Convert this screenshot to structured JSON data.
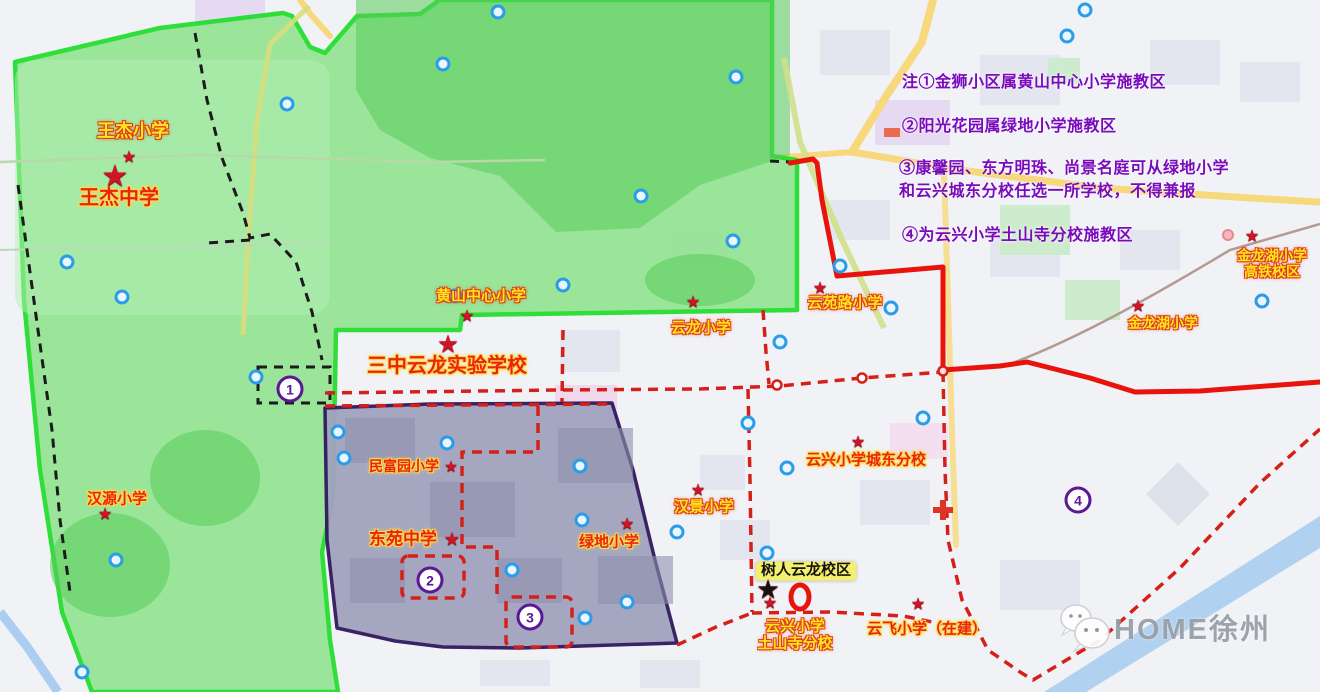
{
  "page": {
    "kind": "school-district-map"
  },
  "watermark": {
    "brand": "HOME徐州"
  },
  "colors": {
    "green_zone_border": "#1fdd2a",
    "green_zone_fill": "#93e493",
    "purple_zone_border": "#31175e",
    "purple_zone_fill": "#a2a3bf",
    "red_boundary": "#e8140c",
    "red_dashed": "#d5201a",
    "black_dashed": "#1b1b1b",
    "note_text": "#7a0bbd",
    "yellow_label": "#ffe520",
    "red_label": "#e8250f",
    "star_red": "#d31326",
    "zone_number": "#5a1796",
    "watermark_gray": "#979da6"
  },
  "notes": [
    {
      "text": "注①金狮小区属黄山中心小学施教区",
      "x": 902,
      "y": 68
    },
    {
      "text": "②阳光花园属绿地小学施教区",
      "x": 902,
      "y": 112
    },
    {
      "text": "③康馨园、东方明珠、尚景名庭可从绿地小学",
      "x": 899,
      "y": 154
    },
    {
      "text": "和云兴城东分校任选一所学校，不得兼报",
      "x": 899,
      "y": 177
    },
    {
      "text": "④为云兴小学土山寺分校施教区",
      "x": 902,
      "y": 221
    }
  ],
  "zone_markers": [
    {
      "n": "1",
      "x": 290,
      "y": 389
    },
    {
      "n": "2",
      "x": 430,
      "y": 580
    },
    {
      "n": "3",
      "x": 530,
      "y": 617
    },
    {
      "n": "4",
      "x": 1078,
      "y": 500
    }
  ],
  "schools": [
    {
      "id": "wangjie-primary",
      "lines": [
        "王杰小学"
      ],
      "style": "y",
      "x": 133,
      "y": 131,
      "fs": 18,
      "star": {
        "x": 129,
        "y": 158,
        "fs": 16
      }
    },
    {
      "id": "wangjie-middle",
      "lines": [
        "王杰中学"
      ],
      "style": "r",
      "x": 119,
      "y": 198,
      "fs": 20,
      "star": {
        "x": 115,
        "y": 177,
        "fs": 30
      }
    },
    {
      "id": "huangshan-central-primary",
      "lines": [
        "黄山中心小学"
      ],
      "style": "y",
      "x": 481,
      "y": 297,
      "fs": 15,
      "star": {
        "x": 467,
        "y": 317,
        "fs": 16
      }
    },
    {
      "id": "sanzhong-yunlong-experimental",
      "lines": [
        "三中云龙实验学校"
      ],
      "style": "r",
      "x": 447,
      "y": 366,
      "fs": 20,
      "star": {
        "x": 448,
        "y": 345,
        "fs": 24
      }
    },
    {
      "id": "yunlong-primary",
      "lines": [
        "云龙小学"
      ],
      "style": "y",
      "x": 701,
      "y": 329,
      "fs": 15,
      "star": {
        "x": 693,
        "y": 303,
        "fs": 16
      }
    },
    {
      "id": "yunyuanlu-primary",
      "lines": [
        "云苑路小学"
      ],
      "style": "y",
      "x": 845,
      "y": 304,
      "fs": 15,
      "star": {
        "x": 820,
        "y": 289,
        "fs": 16
      }
    },
    {
      "id": "jinlonghu-primary-gaotie-campus",
      "lines": [
        "金龙湖小学",
        "高铁校区"
      ],
      "style": "y",
      "x": 1272,
      "y": 264,
      "fs": 14,
      "star": {
        "x": 1252,
        "y": 237,
        "fs": 16
      }
    },
    {
      "id": "jinlonghu-primary",
      "lines": [
        "金龙湖小学"
      ],
      "style": "y",
      "x": 1163,
      "y": 324,
      "fs": 14,
      "star": {
        "x": 1138,
        "y": 307,
        "fs": 16
      }
    },
    {
      "id": "hanyuan-primary",
      "lines": [
        "汉源小学"
      ],
      "style": "r",
      "x": 117,
      "y": 500,
      "fs": 15,
      "star": {
        "x": 105,
        "y": 515,
        "fs": 16
      }
    },
    {
      "id": "minfuyuan-primary",
      "lines": [
        "民富园小学"
      ],
      "style": "r",
      "x": 404,
      "y": 467,
      "fs": 14,
      "star": {
        "x": 451,
        "y": 467,
        "fs": 15
      }
    },
    {
      "id": "dongyuan-middle",
      "lines": [
        "东苑中学"
      ],
      "style": "r",
      "x": 403,
      "y": 539,
      "fs": 17,
      "star": {
        "x": 452,
        "y": 539,
        "fs": 18
      }
    },
    {
      "id": "lvdi-primary",
      "lines": [
        "绿地小学"
      ],
      "style": "r",
      "x": 609,
      "y": 543,
      "fs": 15,
      "star": {
        "x": 627,
        "y": 525,
        "fs": 16
      }
    },
    {
      "id": "hanjing-primary",
      "lines": [
        "汉景小学"
      ],
      "style": "y",
      "x": 704,
      "y": 508,
      "fs": 15,
      "star": {
        "x": 698,
        "y": 491,
        "fs": 16
      }
    },
    {
      "id": "yunxing-chengdong-branch",
      "lines": [
        "云兴小学城东分校"
      ],
      "style": "r",
      "x": 866,
      "y": 461,
      "fs": 15,
      "star": {
        "x": 858,
        "y": 443,
        "fs": 16
      }
    },
    {
      "id": "shuren-yunlong-campus",
      "lines": [
        "树人云龙校区"
      ],
      "style": "b",
      "x": 806,
      "y": 571,
      "fs": 15,
      "star": null
    },
    {
      "id": "yunxing-tushansi-branch",
      "lines": [
        "云兴小学",
        "土山寺分校"
      ],
      "style": "y",
      "x": 795,
      "y": 636,
      "fs": 15,
      "star": null
    },
    {
      "id": "yunfei-primary-under-construction",
      "lines": [
        "云飞小学（在建）"
      ],
      "style": "r",
      "x": 927,
      "y": 630,
      "fs": 15,
      "star": {
        "x": 918,
        "y": 605,
        "fs": 16
      }
    }
  ],
  "extra_markers": [
    {
      "shape": "star",
      "color": "#15120f",
      "x": 768,
      "y": 589,
      "fs": 26,
      "name": "shuren-black-star"
    },
    {
      "shape": "star",
      "color": "#d31326",
      "x": 770,
      "y": 604,
      "fs": 16,
      "name": "tushansi-red-star"
    }
  ]
}
